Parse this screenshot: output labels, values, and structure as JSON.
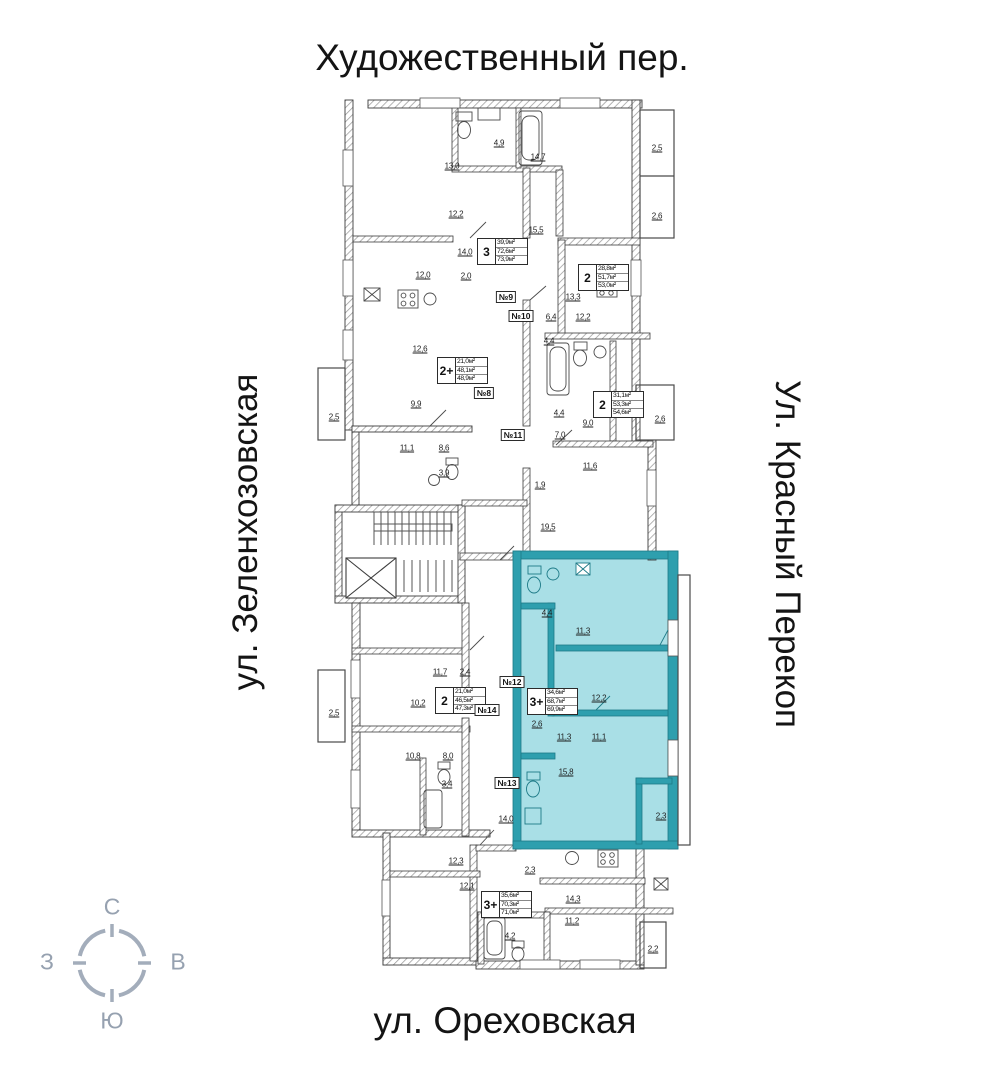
{
  "streets": {
    "top": "Художественный пер.",
    "left": "ул. Зеленхозовская",
    "right": "Ул. Красный Перекоп",
    "bottom": "ул. Ореховская"
  },
  "compass": {
    "north": "С",
    "south": "Ю",
    "west": "З",
    "east": "В"
  },
  "legend": {
    "highlight_color": "#a9dfe6",
    "teal_wall_color": "#2e9fae",
    "wall_color": "#3c3c3c"
  },
  "apartments": [
    {
      "type": "3",
      "areas": [
        "39,9м²",
        "72,6м²",
        "73,9м²"
      ],
      "highlighted": false
    },
    {
      "type": "2",
      "areas": [
        "28,8м²",
        "51,7м²",
        "53,0м²"
      ],
      "highlighted": false
    },
    {
      "type": "2+",
      "areas": [
        "21,0м²",
        "48,1м²",
        "48,9м²"
      ],
      "highlighted": false
    },
    {
      "type": "2",
      "areas": [
        "31,1м²",
        "53,3м²",
        "54,6м²"
      ],
      "highlighted": false
    },
    {
      "type": "2",
      "areas": [
        "21,0м²",
        "46,5м²",
        "47,3м²"
      ],
      "highlighted": false
    },
    {
      "type": "3+",
      "areas": [
        "34,6м²",
        "68,7м²",
        "69,9м²"
      ],
      "highlighted": true
    },
    {
      "type": "3+",
      "areas": [
        "35,6м²",
        "70,3м²",
        "71,0м²"
      ],
      "highlighted": false
    }
  ],
  "units": [
    "№8",
    "№9",
    "№10",
    "№11",
    "№12",
    "№13",
    "№14"
  ],
  "dims": [
    "13,0",
    "4,9",
    "14,7",
    "2,5",
    "12,2",
    "2,6",
    "15,5",
    "14,0",
    "12,0",
    "2,0",
    "13,3",
    "6,4",
    "12,2",
    "12,6",
    "4,4",
    "9,9",
    "4,4",
    "9,0",
    "2,6",
    "7,0",
    "11,1",
    "8,6",
    "11,6",
    "3,9",
    "1,9",
    "19,5",
    "2,5",
    "2,5",
    "11,7",
    "2,4",
    "4,4",
    "11,3",
    "12,2",
    "2,6",
    "11,3",
    "11,1",
    "15,8",
    "10,2",
    "10,8",
    "8,0",
    "3,4",
    "14,0",
    "2,3",
    "12,3",
    "12,1",
    "2,3",
    "14,3",
    "11,2",
    "4,2",
    "2,2"
  ]
}
